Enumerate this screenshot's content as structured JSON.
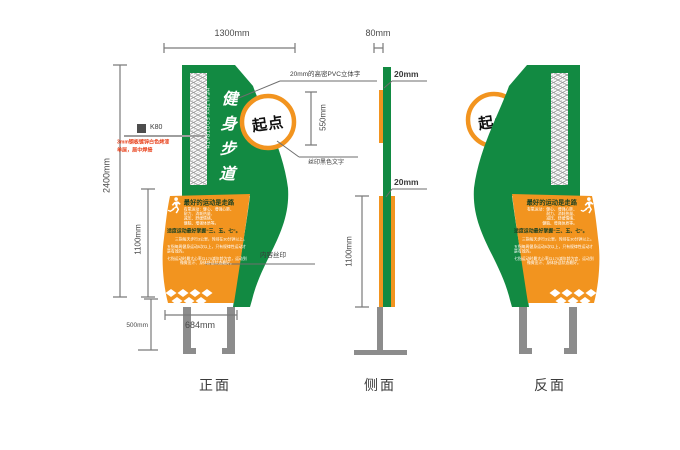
{
  "colors": {
    "green": "#128a42",
    "orange": "#f2941f",
    "ring_orange": "#f2941f",
    "post_gray": "#8c8c8c",
    "dim_gray": "#7a7a7a",
    "note_red": "#e8421c",
    "hatch_gray": "#969696",
    "panel_text_dark": "#173f21"
  },
  "dims": {
    "width": "1300mm",
    "thickness": "80mm",
    "height": "2400mm",
    "panel_front": "1100mm",
    "panel_side": "1100mm",
    "circle": "550mm",
    "base": "684mm",
    "post": "500mm",
    "t_top": "20mm",
    "t_bottom": "20mm"
  },
  "annotations": {
    "pvc": "20mm的高密PVC立体字",
    "silk": "丝印黑色文字",
    "content": "内容丝印",
    "k80": "K80",
    "material_1": "3mm钢板镀锌白色烤漆",
    "material_2": "单层，居中焊接"
  },
  "sign": {
    "vertical_title": "健身步道",
    "vertical_subtitle": "HEALTHY FOOTPATH",
    "start_label": "起点",
    "panel": {
      "title": "最好的运动是走路",
      "sub_lines": [
        "有氧运动：健心、增强心肺、",
        "耐力、消耗热量、",
        "减压、舒缓情绪、",
        "健脑、增强体质等。"
      ],
      "highlight": "适度运动最好掌握“三、五、七”。",
      "paragraphs": [
        "三指每天步行3公里，时间在30分钟以上。",
        "五指每周健身运动5次以上，只有规律性运动才是有效的。",
        "七指运动时最大心率以170减年龄为宜，运动到微微出汗、身体舒适状态最好。"
      ]
    }
  },
  "views": {
    "front": "正面",
    "side": "侧面",
    "back": "反面"
  }
}
